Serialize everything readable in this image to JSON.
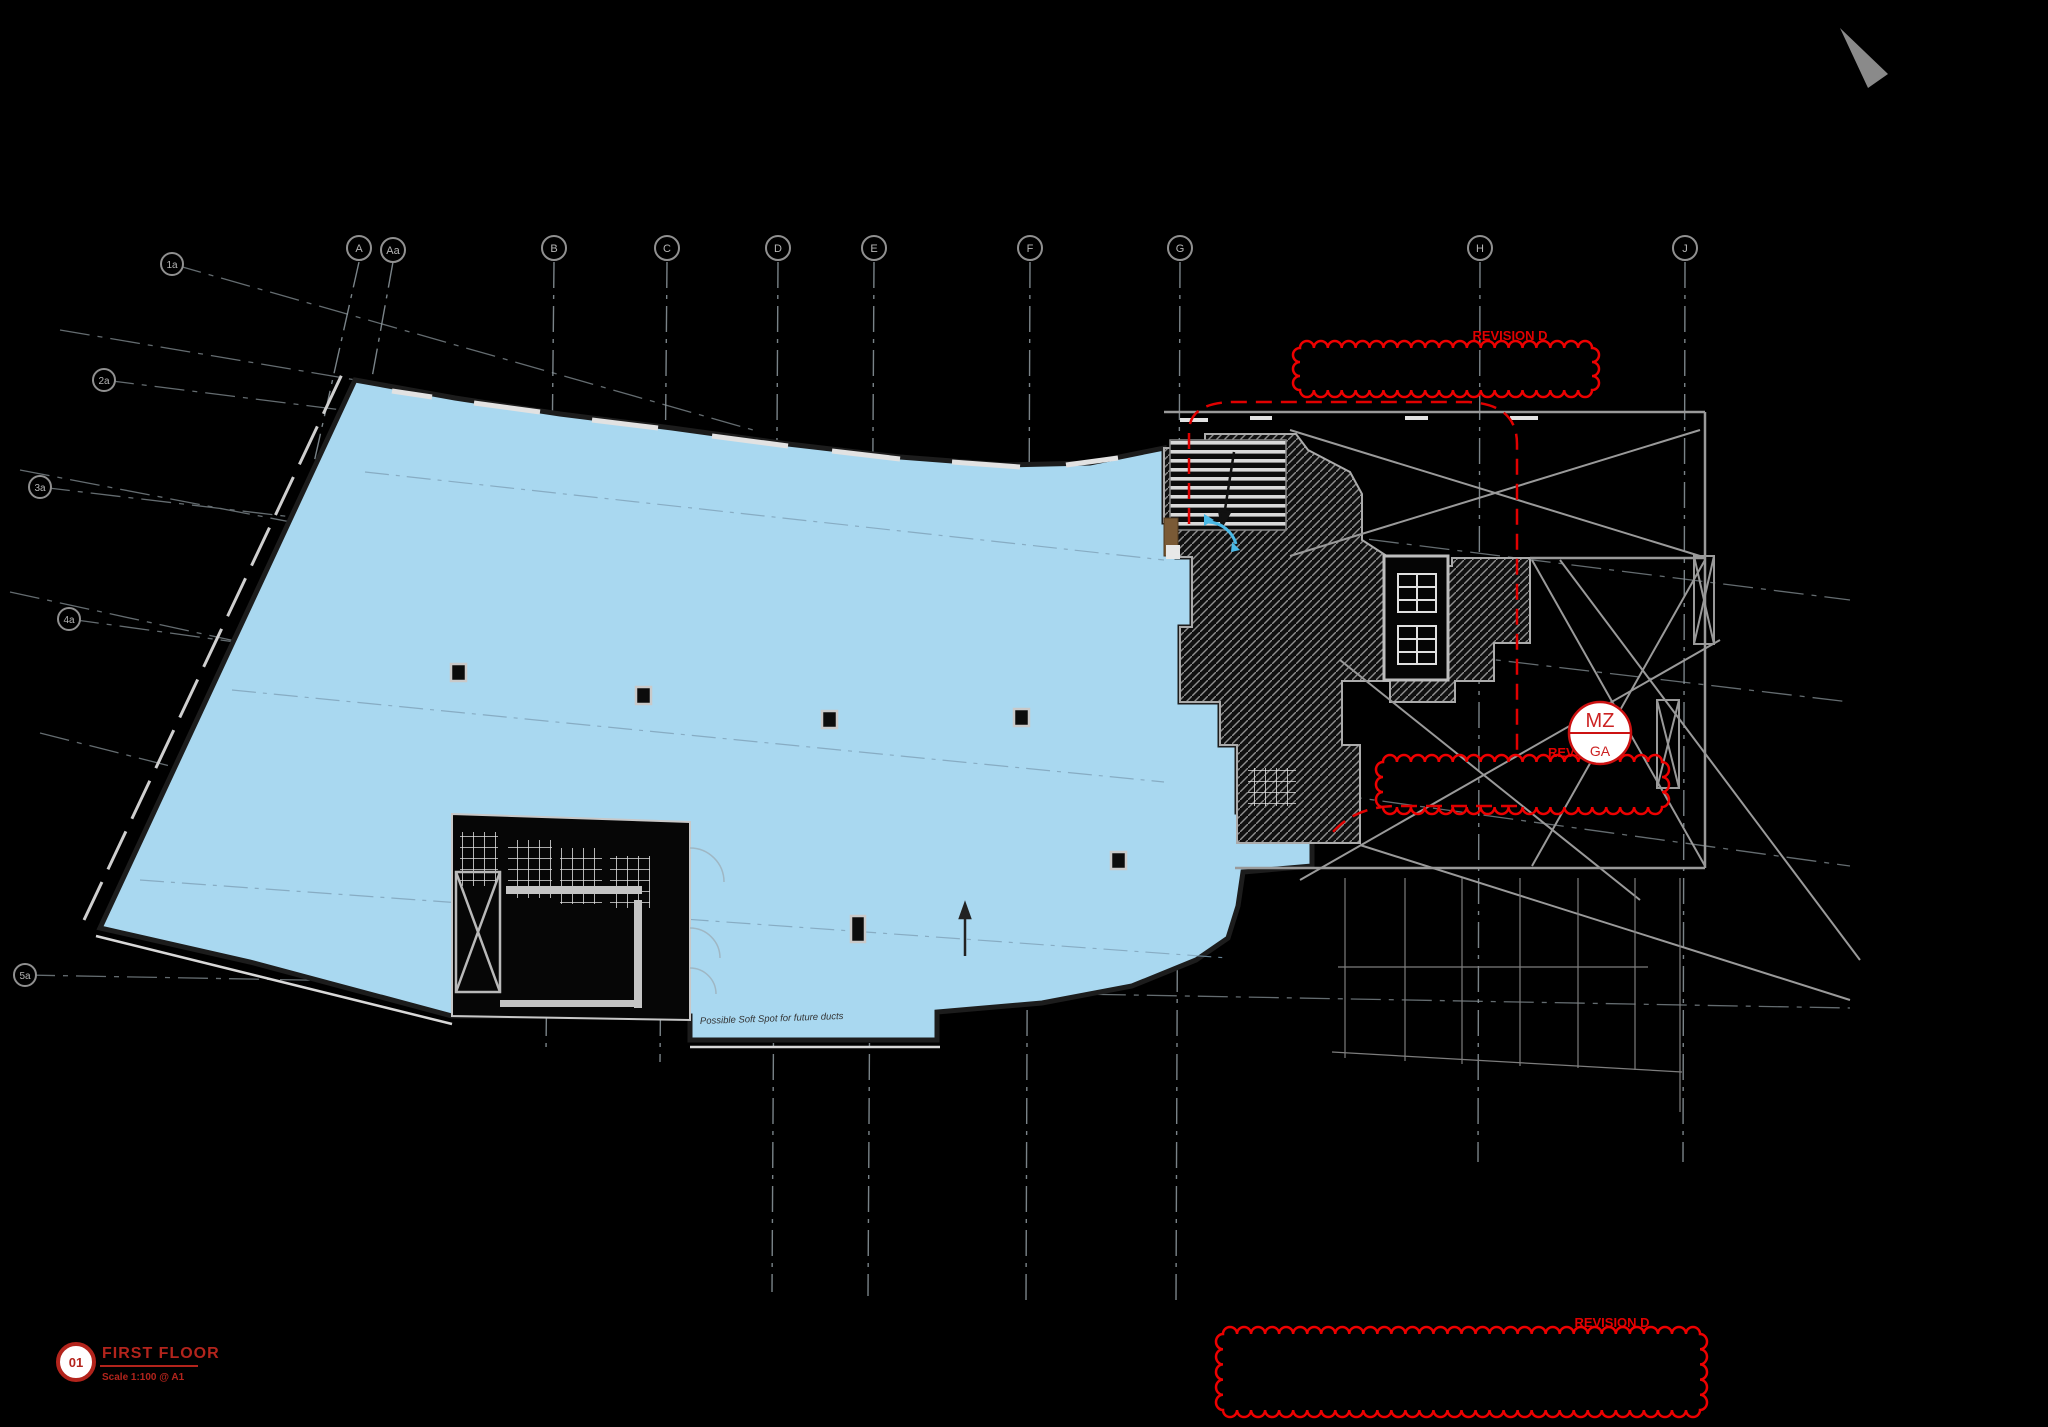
{
  "drawing": {
    "title_block": {
      "number": "01",
      "title": "FIRST FLOOR",
      "scale": "Scale 1:100 @ A1"
    },
    "grid": {
      "top_labels": [
        "A",
        "Aa",
        "B",
        "C",
        "D",
        "E",
        "F",
        "G",
        "H",
        "J"
      ],
      "left_labels": [
        "1a",
        "2a",
        "3a",
        "4a",
        "5a"
      ]
    },
    "revisions": {
      "top": "REVISION D",
      "middle": "REVISION D",
      "bottom": "REVISION D"
    },
    "marker": {
      "top": "MZ",
      "bottom": "GA"
    },
    "note": "Possible Soft Spot for future ducts",
    "colors": {
      "background": "#000000",
      "floor_blue": "#a9d8f0",
      "cloud_red": "#ee0000",
      "title_red": "#b3241c",
      "line_gray": "#9a9a9a",
      "wall_white": "#d8d8d8",
      "hatch_gray": "#8f8f8f",
      "door_cyan": "#4ab9e6",
      "timber_brown": "#7a5a36"
    }
  }
}
